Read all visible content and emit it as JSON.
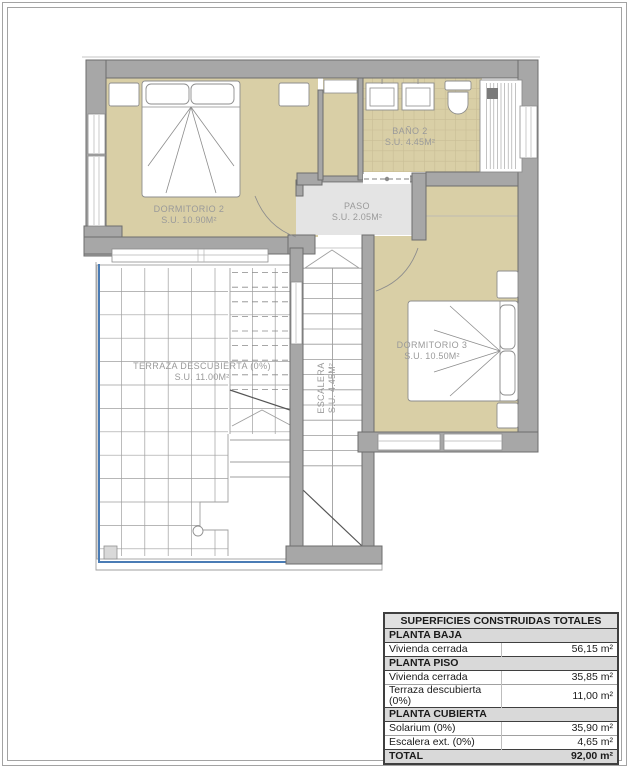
{
  "sheet": {
    "width": 629,
    "height": 768
  },
  "plan": {
    "rooms": [
      {
        "id": "dormitorio-2",
        "label": "DORMITORIO 2",
        "area": "S.U. 10.90m²"
      },
      {
        "id": "bano-2",
        "label": "BAÑO 2",
        "area": "S.U. 4.45m²"
      },
      {
        "id": "paso",
        "label": "PASO",
        "area": "S.U. 2.05m²"
      },
      {
        "id": "dormitorio-3",
        "label": "DORMITORIO 3",
        "area": "S.U. 10.50m²"
      },
      {
        "id": "terraza",
        "label": "TERRAZA DESCUBIERTA (0%)",
        "area": "S.U. 11.00m²"
      },
      {
        "id": "escalera",
        "label": "ESCALERA",
        "area": "S.U. 4.45m²"
      }
    ],
    "colors": {
      "room_fill": "#d9cfa6",
      "wall_fill": "#a7a7a7",
      "wall_stroke": "#6d6d6d",
      "paso_fill": "#e4e4e4",
      "tile_line": "#c9be96",
      "grid_line": "#9f9f9f",
      "railing_blue": "#4a7cb5",
      "label_text": "#9a9a9a",
      "furniture_stroke": "#8d8d8d"
    }
  },
  "table": {
    "title": "SUPERFICIES CONSTRUIDAS TOTALES",
    "rows": [
      {
        "type": "section",
        "label": "PLANTA BAJA",
        "value": ""
      },
      {
        "type": "item",
        "label": "Vivienda cerrada",
        "value": "56,15 m²"
      },
      {
        "type": "section",
        "label": "PLANTA PISO",
        "value": ""
      },
      {
        "type": "item",
        "label": "Vivienda cerrada",
        "value": "35,85 m²"
      },
      {
        "type": "item",
        "label": "Terraza descubierta (0%)",
        "value": "11,00 m²"
      },
      {
        "type": "section",
        "label": "PLANTA CUBIERTA",
        "value": ""
      },
      {
        "type": "item",
        "label": "Solarium (0%)",
        "value": "35,90 m²"
      },
      {
        "type": "item",
        "label": "Escalera ext. (0%)",
        "value": "4,65 m²"
      },
      {
        "type": "total",
        "label": "TOTAL",
        "value": "92,00 m²"
      }
    ],
    "colors": {
      "section_bg": "#d9d9d9",
      "title_bg": "#e0e0e0",
      "border_dark": "#3f3f3f",
      "row_line": "#a0a0a0"
    }
  }
}
